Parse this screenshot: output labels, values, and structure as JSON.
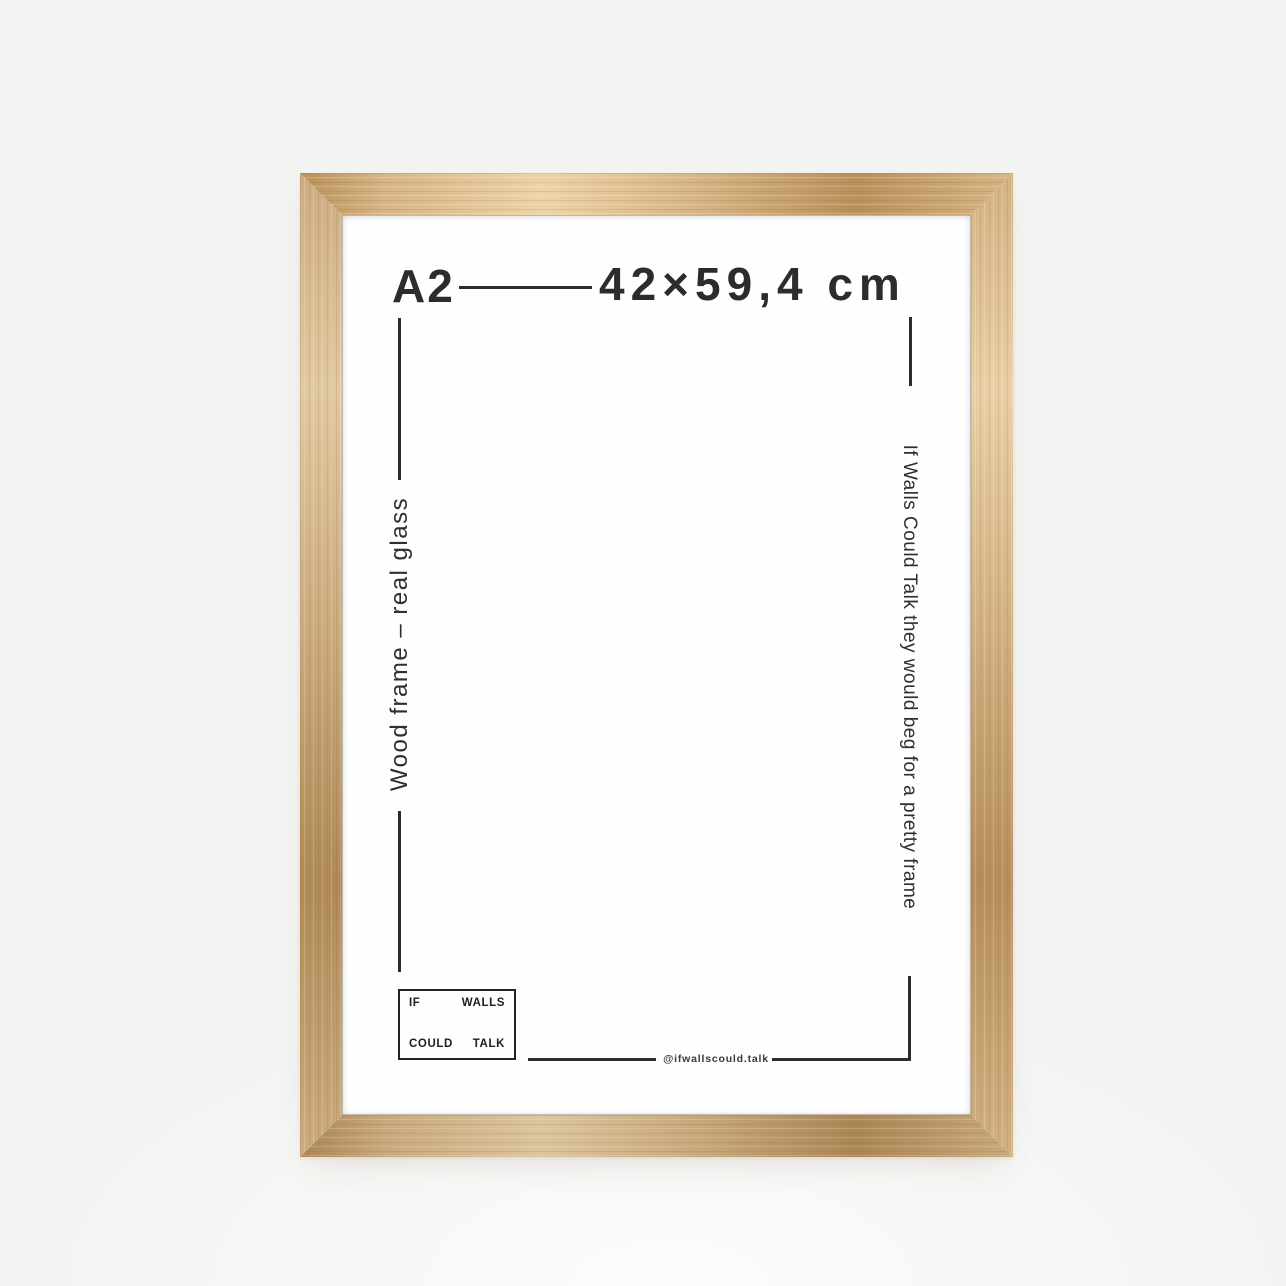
{
  "photo": {
    "size_label": "A2",
    "dimensions_label": "42×59,4 cm",
    "left_note": "Wood frame – real glass",
    "right_note": "If Walls Could Talk they would beg for a pretty frame",
    "handle": "@ifwallscould.talk",
    "logo": {
      "word1": "IF",
      "word2": "WALLS",
      "word3": "COULD",
      "word4": "TALK"
    }
  },
  "colors": {
    "background": "#f3f3f1",
    "background_glow": "#fcfcfb",
    "wood_base": "#cfae80",
    "wood_dark": "#b18a58",
    "wood_light": "#e3cba2",
    "paper": "#fefefe",
    "ink": "#2c2c2c"
  }
}
